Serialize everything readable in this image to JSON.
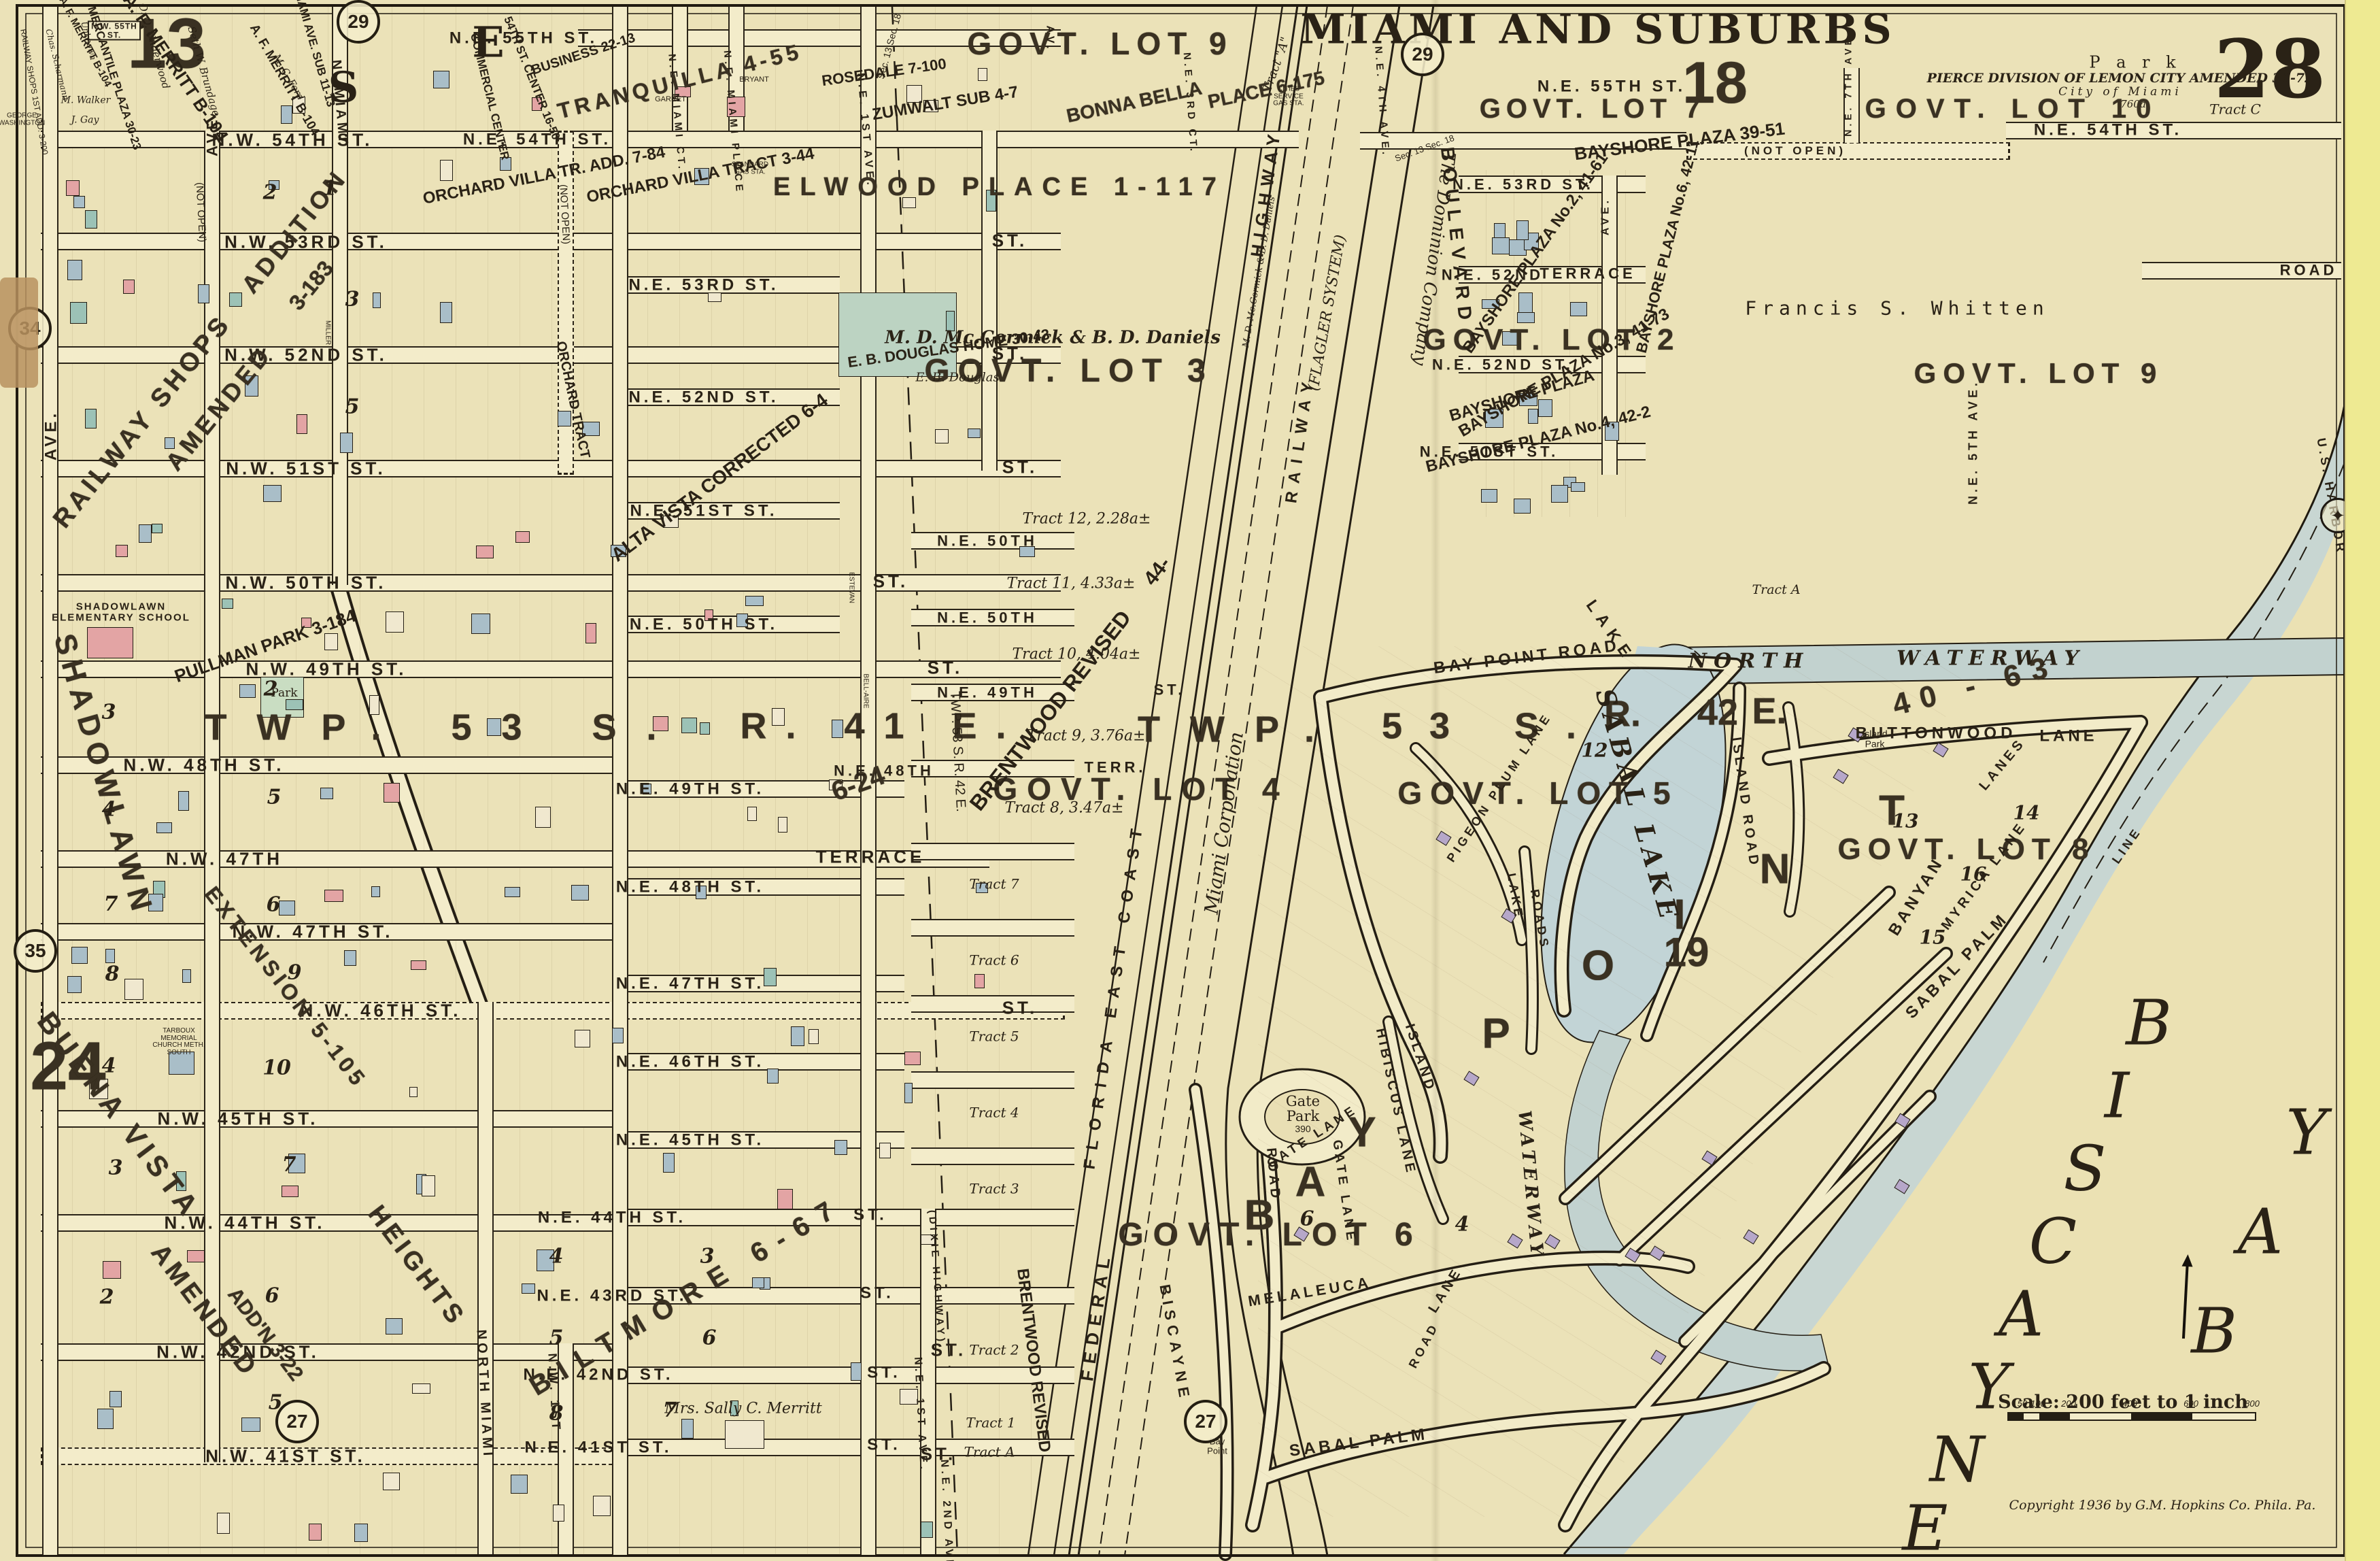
{
  "sheet": {
    "plate": "28",
    "plate_left": "13",
    "plate_bottom_left": "24",
    "plate_top": "18",
    "plate_bay": "19",
    "title": "MIAMI AND SUBURBS",
    "park": "P a r k",
    "pierce": "PIERCE DIVISION OF LEMON CITY AMENDED 31-72",
    "city": "City of Miami",
    "acreage": "760a",
    "tract_c": "Tract C",
    "scale": "Scale: 200 feet to 1 inch",
    "ticks": [
      "50",
      "100",
      "200",
      "400",
      "600",
      "800"
    ],
    "copyright": "Copyright 1936 by G.M. Hopkins Co. Phila. Pa.",
    "badges": [
      "29",
      "29",
      "34",
      "35",
      "27",
      "27"
    ]
  },
  "gl": [
    "GOVT. LOT 9",
    "GOVT. LOT 7",
    "GOVT. LOT 10",
    "GOVT. LOT 3",
    "GOVT. LOT 2",
    "GOVT. LOT 9",
    "GOVT. LOT 4",
    "GOVT. LOT 5",
    "GOVT. LOT 8",
    "GOVT. LOT 6"
  ],
  "tw": {
    "west": "TWP. 53 S.",
    "west_r": "R. 41 E.",
    "e_twp": "TWP.",
    "e_53": "53 S.",
    "e_r": "R.",
    "e_42": "42",
    "e_e": "E.",
    "plat": "40 - 63",
    "range_line": "TWP. 53 S.   R. 42 E.",
    "shadowlawn_plat": "6-24"
  },
  "stn": [
    "N.W. 55TH ST.",
    "N.W. 54TH ST.",
    "N.W. 53RD ST.",
    "N.W. 52ND ST.",
    "N.W. 51ST ST.",
    "N.W. 50TH ST.",
    "N.W. 49TH ST.",
    "N.W. 48TH ST.",
    "N.W. 47TH",
    "N.W. 47TH ST.",
    "N.W. 46TH ST.",
    "N.W. 45TH ST.",
    "N.W. 44TH ST.",
    "N.W. 42ND ST.",
    "N.W. 41ST ST."
  ],
  "ste": [
    "N.E. 55TH ST.",
    "N.E. 54TH ST.",
    "N.E. 53RD ST.",
    "N.E. 52ND ST.",
    "N.E. 51ST ST.",
    "N.E. 50TH ST.",
    "N.E. 49TH ST.",
    "N.E. 48TH ST.",
    "N.E. 47TH ST.",
    "N.E. 46TH ST.",
    "N.E. 45TH ST.",
    "N.E. 44TH ST.",
    "N.E. 43RD ST.",
    "N.E. 42ND ST.",
    "N.E. 41ST ST.",
    "N.E. 50TH",
    "N.E. 49TH",
    "N.E. 48TH"
  ],
  "str": [
    "N.E. 55TH ST.",
    "N.E. 54TH ST.",
    "N.E. 53RD ST.",
    "N.E. 52ND",
    "N.E. 52ND ST.",
    "N.E. 51ST ST.",
    "ROAD"
  ],
  "av": {
    "ave": "AVE.",
    "nmiami": "N. MIAMI",
    "north_miami": "NORTH MIAMI",
    "nw1": "N.W. 1ST",
    "ne_miami_ct": "N.E. MIAMI CT.",
    "ne_miami_pl": "N.E. MIAMI PLACE",
    "ne1": "N.E. 1ST AVE.",
    "av": "AV.",
    "ne2": "N.E. 2ND AVE.",
    "dixie": "(DIXIE HIGHWAY)",
    "ne3ct": "N.E. 3RD CT.",
    "ne4": "N.E. 4TH AVE.",
    "ne5": "N.E. 5TH AVE.",
    "ne7": "N.E. 7TH AVE.",
    "blvd": "BOULEVARD",
    "biscayne": "BISCAYNE"
  },
  "co": {
    "federal": "FEDERAL",
    "highway": "HIGHWAY",
    "fec": "FLORIDA EAST COAST",
    "railway": "RAILWAY",
    "flagler": "(FLAGLER SYSTEM)",
    "dominion": "The Dominion Company",
    "miami_corp": "Miami Corporation",
    "tract_a": "Tract \"A\""
  },
  "sb": {
    "railway_shops": "RAILWAY SHOPS",
    "amended": "AMENDED",
    "addition": "ADDITION",
    "plat3183": "3-183",
    "shops_add": "RAILWAY SHOPS 1ST ADD. 3-200",
    "shadowlawn": "SHADOWLAWN",
    "extension": "EXTENSION 5-105",
    "pullman": "PULLMAN PARK 3-184",
    "park_sm": "Park",
    "buena": "BUENA VISTA",
    "heights": "HEIGHTS",
    "addn": "ADD'N 3-22",
    "alta": "ALTA VISTA CORRECTED 6-4",
    "orchard_tract": "ORCHARD TRACT",
    "ova": "ORCHARD VILLA TR. ADD. 7-84",
    "ovt": "ORCHARD VILLA TRACT 3-44",
    "douglas": "E. B. DOUGLAS HOME 30-43",
    "douglas_sig": "E. B. Douglas",
    "elwood": "ELWOOD PLACE 1-117",
    "tranquilla": "TRANQUILLA 4-55",
    "bonna": "BONNA BELLA",
    "bonna2": "PLACE 6-175",
    "zumwalt": "ZUMWALT SUB 4-7",
    "rosedale": "ROSEDALE 7-100",
    "commercial": "COMMERCIAL CENTER",
    "center54": "54TH ST. CENTER 16-50",
    "business": "BUSINESS 22-13",
    "miami_ave_sub": "MIAMI AVE. SUB 11-13",
    "mercantile": "MERCANTILE PLAZA 30-23",
    "biltmore": "BILTMORE 6-67",
    "brentwood": "BRENTWOOD REVISED",
    "b44": "44-",
    "bayshore1": "BAYSHORE PLAZA 39-51",
    "bayshore2": "BAYSHORE PLAZA No.2, 41-61",
    "bayshore3": "BAYSHORE PLAZA No.3, 41-73",
    "bayshore4": "BAYSHORE PLAZA No.4, 42-2",
    "bayshore5": "BAYSHORE PLAZA",
    "bayshore6": "BAYSHORE PLAZA No.6, 42-11"
  },
  "ow": {
    "mccormick": "M. D. Mc.Cormick & B. D. Daniels",
    "whitten": "Francis  S.  Whitten",
    "merritt": "Mrs. Sally C. Merritt",
    "merritt_b104": "A. F. MERRITT B-104",
    "underwood": "O. O. Underwood",
    "brundage": "Seth W. Brundage",
    "ford": "M. C. Ford",
    "walker": "M. Walker",
    "gay": "J. Gay",
    "scharmann": "Chas. Scharmann",
    "unknown": "Unknown",
    "washington": "GEORGE WASHINGTON"
  },
  "lm": {
    "school": "SHADOWLAWN ELEMENTARY SCHOOL",
    "church": "TARBOUX MEMORIAL CHURCH METH. SOUTH",
    "cities": "CITIES SERVICE GAS STA.",
    "standard": "STANDARD GAS STA.",
    "bryant": "BRYANT",
    "garret": "GARRET",
    "miller": "MILLER",
    "bellaire": "BELL-AIRE",
    "estevan": "ESTEVAN",
    "gate_park": "Gate Park",
    "g390": "390",
    "island_park": "Island Park",
    "bay_point_sm": "Bay Point"
  },
  "tr": [
    "Tract 12, 2.28a±",
    "Tract 11, 4.33a±",
    "Tract 10, 4.04a±",
    "Tract 9, 3.76a±",
    "Tract 8, 3.47a±",
    "Tract 7",
    "Tract 6",
    "Tract 5",
    "Tract 4",
    "Tract 3",
    "Tract 2",
    "Tract 1",
    "Tract A"
  ],
  "bn": [
    "2",
    "1",
    "3",
    "5",
    "3",
    "4",
    "2",
    "5",
    "7",
    "6",
    "8",
    "9",
    "4",
    "10",
    "3",
    "7",
    "2",
    "6",
    "5",
    "4",
    "3",
    "5",
    "6",
    "8",
    "7",
    "6",
    "4",
    "12",
    "16",
    "15",
    "13",
    "14"
  ],
  "bp": {
    "letters": [
      "B",
      "A",
      "Y",
      "P",
      "O",
      "I",
      "N",
      "T"
    ],
    "road": "BAY POINT ROAD",
    "lake_rd": "LAKE",
    "gate_ln": "GATE LANE",
    "melaleuca": "MELALEUCA",
    "lane": "LANE",
    "sabal_palm": "SABAL PALM",
    "lanes": "LANES",
    "banyan": "BANYAN",
    "myrica": "MYRICA LANE",
    "buttonwood": "BUTTONWOOD",
    "island_rd": "ISLAND ROAD",
    "island": "ISLAND",
    "pigeon": "PIGEON PLUM LANE",
    "hibiscus": "HIBISCUS LANE",
    "lake_v": "LAKE",
    "roads_v": "ROADS",
    "broad": "ROAD",
    "road2": "ROAD",
    "tract_a": "Tract A"
  },
  "wa": {
    "biscayne": [
      "B",
      "I",
      "S",
      "C",
      "A",
      "Y",
      "N",
      "E"
    ],
    "bay": [
      "B",
      "A",
      "Y"
    ],
    "lake": "SABAL LAKE",
    "north": "NORTH",
    "waterway": "WATERWAY",
    "waterway2": "WATERWAY",
    "harbor": "U.S. HARBOR",
    "line": "LINE"
  },
  "mi": {
    "st": "ST.",
    "not_open": "(NOT OPEN)",
    "sec": "Sec. 13   Sec. 18",
    "s": "S",
    "e": "E",
    "terr": "TERR.",
    "terrace": "TERRACE"
  }
}
